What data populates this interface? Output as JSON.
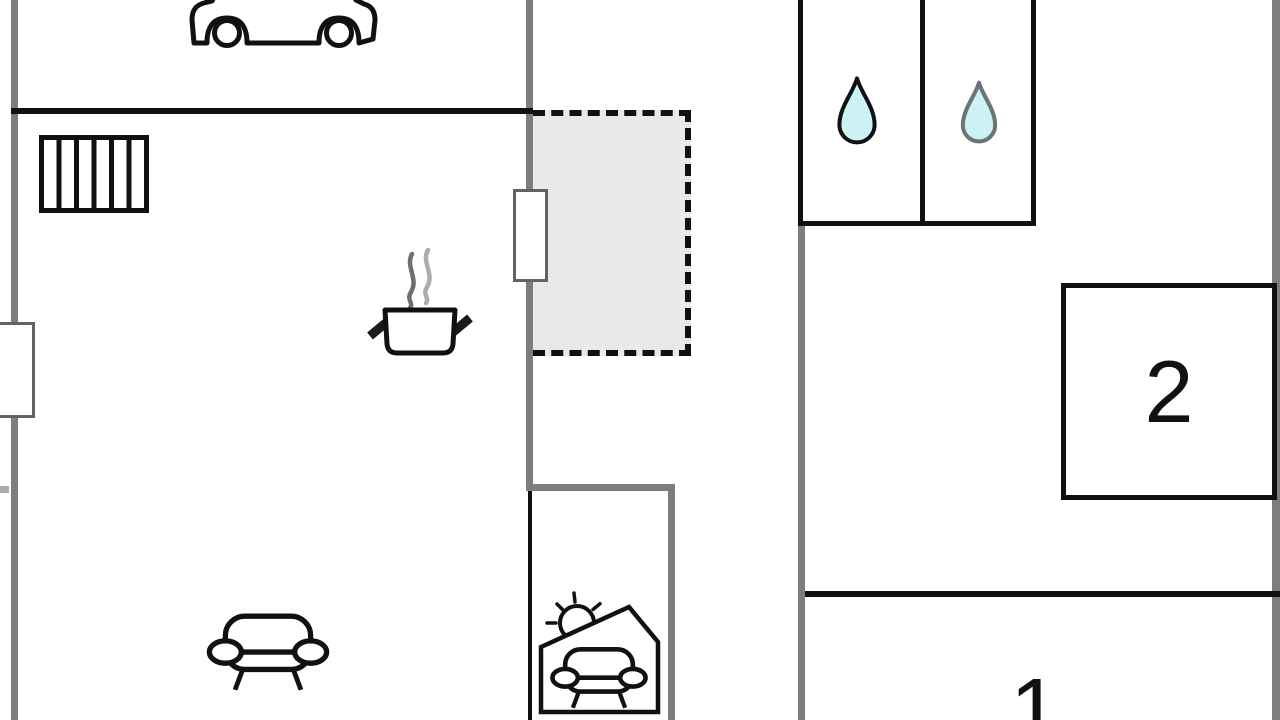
{
  "floorplan": {
    "rooms": {
      "room1": {
        "label": "1"
      },
      "room2": {
        "label": "2"
      }
    },
    "icons": {
      "garage": "car-icon",
      "staircase": "stairs-icon",
      "kitchen": "cooking-pot-icon",
      "kitchen_steam": "steam-icon",
      "living_room": "sofa-icon",
      "bathroom_left": "water-drop-icon",
      "bathroom_right": "water-drop-icon",
      "sunroom_sun": "sun-icon",
      "sunroom_seating": "sofa-icon"
    },
    "colors": {
      "background": "#ffffff",
      "wall_gray": "#7d7d7d",
      "line_black": "#111111",
      "dashed_area_fill": "#e9e9e9",
      "water_drop_fill": "#cdf2f5",
      "window_fill": "#ffffff"
    }
  }
}
